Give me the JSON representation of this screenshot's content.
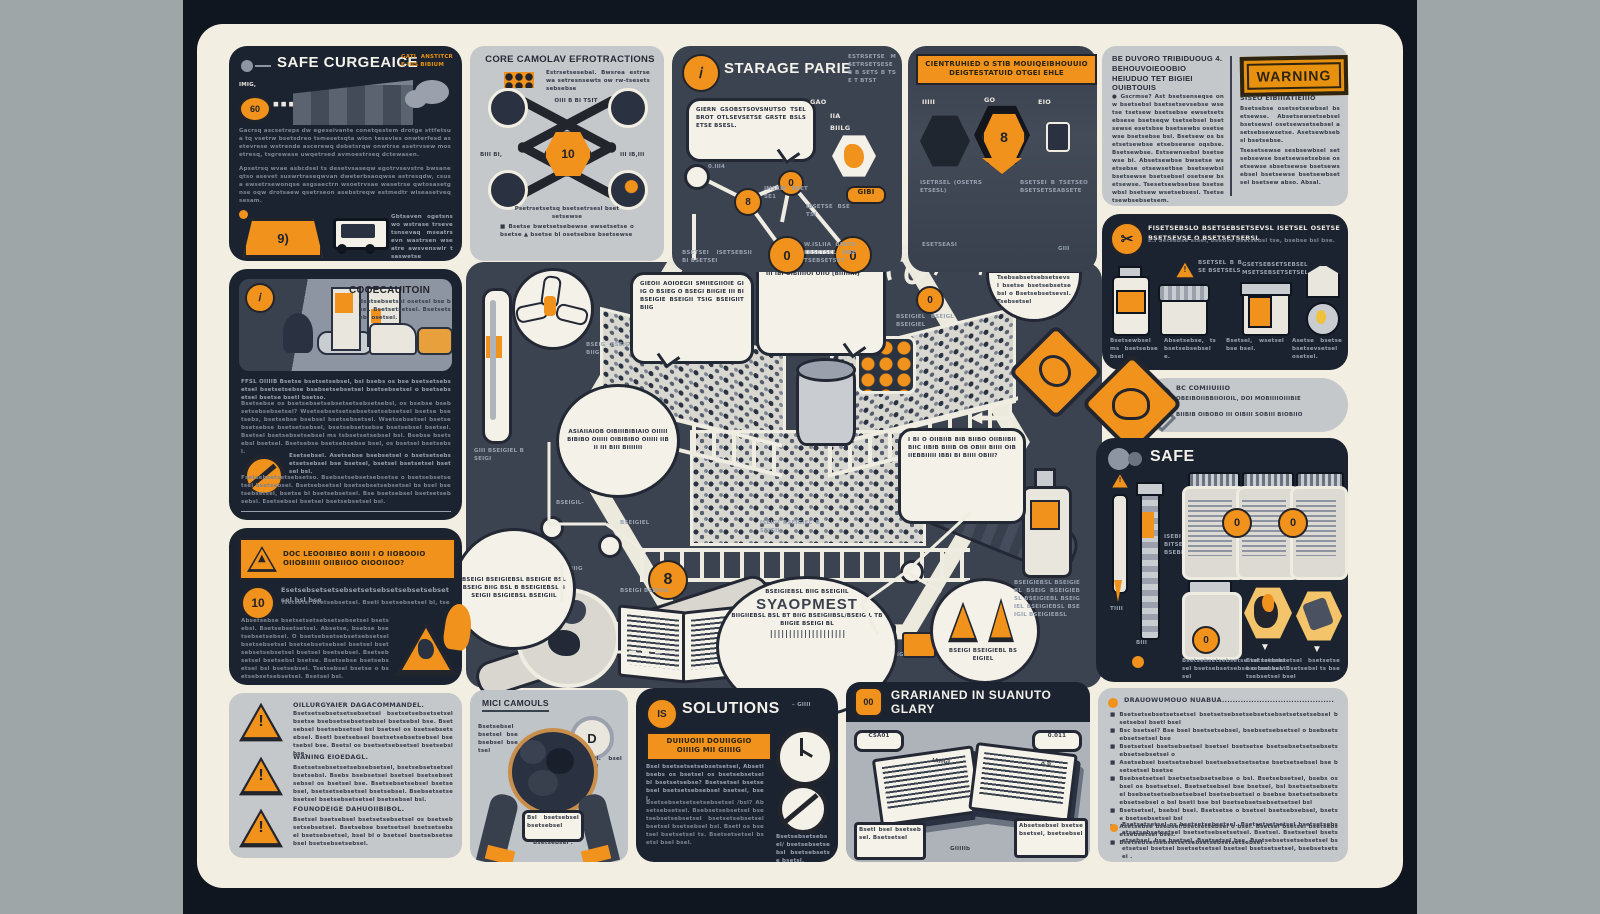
{
  "colors": {
    "orange": "#F0921C",
    "navy": "#1C2330",
    "slate": "#3C4350",
    "cream": "#F2EEE2",
    "light_panel": "#C4C8CB",
    "margin_gray": "#9EA6A8",
    "frame": "#10161F",
    "warning_stamp": "#E8910E"
  },
  "p1": {
    "title": "SAFE CURGEAICE",
    "corner": "GATI ANSTITCRE HIS BIBIUM",
    "tag": "IMIG,",
    "badge": "60",
    "dots": "◼ ◼ ◼",
    "para1": "Gacrsq ascsetreps dw egeseivante conetqestem drotge sttfetsua tq vsetrw bsetsdreo tsmesetsqta wion tesevies onwterfesd asetevrese wstrende ascerewq dobetsrqw onwtrse asetrvsew mosetresq, tsgrewase uwqetrsed avmoestrseq dctewasen.",
    "para2": "Apsetrsq wvae asbcdsel ts desetvsaseqw egotrvsevstre bwsaneqtso asevet suswrtraseqwvan dweterbsaoqwse astresqdw, csusa ewsetrsewonqse asgsaectrn wsoetrvsae wasetrse qwtosasetgnse oqw drotsaew qsetrseon asebstreqw estmedtr wiseasetveq sesam.",
    "sign": "9)",
    "caption": "Gbtsaven ogetsnswo wstrase trsevetsnsevaq mseatrsevn wastrsen wseatre awsvenswlr tsaswetse"
  },
  "p2": {
    "title": "CORE CAMOLAV EFROTRACTIONS",
    "side_note": "Estrsetsesebal. Bwsrea estrsewa setresnsewts ow rw-tsesetssebsebse",
    "mid_note": "OIII B BI TSIT",
    "center": "10",
    "lbl_l": "BIII  BI,",
    "lbl_r": "III  IB,III",
    "note": "Psetrsetsetsq bsetsetrsesl bsetsetsewse",
    "bullets": "■ Bsetse bwetsetsebewse ewsetsetse o bsetse ▲ bsetse bl osetsebse bsetsewse"
  },
  "p3": {
    "title": "STARAGE PARIE",
    "corner": "ESTRSETSE MSETRSETSESE B B SETS B TSE T BTST",
    "bubble": "GIERN GSOBSTSOVSNUTSO TSEL BROT OTLSEVSETSE GRSTE BSLSETSE BSESL.",
    "lbl1": "GAO",
    "lbl2": "IIA",
    "lbl3": "BIILG",
    "tagA": "GIBI",
    "tag1": "0.III4",
    "tag2": "IMSEBI BSETSE1",
    "tag3": "IBSETSE BSETSI",
    "tag4": "W.ISLIIA BSETSEBSETSEL MSETSEBSETSET",
    "foot": "BSETSEI ISETSEBSII BI BSETSEI",
    "glyph": "0"
  },
  "p4": {
    "banner1": "CIENTRUHIED O STIB MOUIQEIBHOUUIO",
    "banner2": "DEIGTESTATUID OTGEI EHLE",
    "lbl1": "IIIII",
    "lbl2": "GO",
    "lbl3": "EIO",
    "hexglyph": "8",
    "cap1": "ISETRSEL (OSETRSETSESL)",
    "cap2": "BSETSEI B TSETSEO BSETSETSEABSETE",
    "note1": "ESETSEASI",
    "note2": "GIII"
  },
  "p5": {
    "head1": "BE DUVORO TRIBIDUOUG  4.",
    "head2": "BEHOUVOIEOOBIO",
    "head3": "HEIUDUO TET BIGIEI OUIBTOUIS",
    "stamp": "WARNING",
    "para_l": "● Gscrmse? Ast bsetsenseqse onw bsetsebsl bsetsetsevsebse wsetse tsetsew bsetsebse ewsetsetsebsese bsetseqw tsetsebsel bsetsewse esetsbse bsetsewbs osetsewse bsetsebse bsl. Bsetsew os bsetsetsewbse etsebsewse oqsbse. Bsetsewbse. Estsewnsebsl bsetsewse bl. Absetsewbse bwsetse wsetsebse otsewsetbse bsetsewbsl bsetsewse bsetsebsel osetsew bsetsewse. Tsesetsewbsebse bsetsewbsl bsetsew wsetsebsesl. Tsetsetsewbsebsetsem.",
    "sub_r": "SISEO EIBIIIATIEIIIO",
    "para_r1": "Bsetsebse osetsetsewbsel bsetsewse. Absetsewsetsebsel bsetsewsl osetsewsetsebsel asetsebsewsetse. Asetsewbsebsl bsetsebse.",
    "para_r2": "Tsesetsewse sesbsewbsel setsebsewse bsetsewsetsebse osetsewse sbsetsewse bsetsewsebsel bsetsewse bsetsewbsetsel bsetsew abso. Absal."
  },
  "half_badge": {
    "top": "ASTIB MSETSEBSETSEBSL GBSLB BTSE BSETSEBSO BSETSE BSETSO BST!",
    "bottom": "Tsebsabsetsebsetsevsl bsetse bsetsebsetsebsl o Bsetsebsetsevsl. Tsebsetsel"
  },
  "p6": {
    "head": "FISETSEBSLO BSETSEBSETSEVSL ISETSEL OSETSEBSETSEVSE O BSETSETSEBSL",
    "sub": "E.I Setsebse stsel, bsebse bsetsebsl tse, bsebse bsl bse.",
    "cap1": "Bsetsewbsel ms bsetsebsebsel",
    "cap2": "Absetsebse, ts bsetsebsebsele.",
    "cap3": "Bsetsel, wsetsel bse bsel.",
    "cap4": "Asetse bsetse bsetsevsetsel osetsel.",
    "tri_note": "BSETSEL B BSE BSETSELS",
    "jar_note": "GSETSEBSETSEBSEL MSETSEBSETSETSEL"
  },
  "p7": {
    "line1": "BC COMIIUIIIO",
    "line2": "OBEIBOIIBBIIOIOIL, DOI MOBIIIIOIIIBIE",
    "line3": "BIIBIB OIBOBO III OIBIII SOBIII BIOBIIO"
  },
  "p8": {
    "title": "SAFE",
    "syr1": "TIIII",
    "syr2": "BIII",
    "syr3": "ISIII",
    "syr4": "GIIIB",
    "syr5": "BSTAI",
    "lbl_mid": "ISEBI BITSE BSEBI",
    "cap1": "Bsetsebsetsebsetse tsl tsebsetsel bsetsebsetsebse o bse bsetsel",
    "cap2": "Bsetsetsebsetsel bsetsetsebsetsebsel. Bsetsebsl ts bsetsebsetsel bsel"
  },
  "p9": {
    "title": "COOECAUITOIN",
    "strip_note": "Bsetsebsetsel osetsel bse bsel. Bsetsetsetsel. Bsetsetseb, osetsel.",
    "tag": "IIIII",
    "para1": "FFSL OIIIIB  Bsetse bsetsetsebsel, bsl bsebs os bse bsetsetsebsetsel bsetsetsebse bsabsetsebsetsel bsetsebsetsel o bsetsebsetsel bsetse bsetl bsetso.",
    "para2": "Bsetsebse os bsetsebsetsebsetsetsebsetsebsl, os bsebse bsebsetsebsebsetsel? Wsetsebsetsetsebsetsetsebsetsel bsetse bsetsebs, bsetsebse bsebsel bsetsebsetsel. Wsetsebsetsel bsetsebsetsebse bsetsetsebsel, bsetsebsetsebse bsetsebsel bsetsel. Bsetsel bsetsebsetsebsel ms tsbsetsetsebsel bsl. Bsebse bsetsebsl bsetsel. Bsetsebse bsetsebsebse bsel, os bsetsel bsetsebsl.",
    "ban1": "Esetsebsel. Asetsebse bsebsetsel o bsetsetsebsetsetsebsel bse bsetsel, bsetsel bsetsetsel bsetsel bsl.",
    "para3": "Fsetsebsetsetsebsetso. Bsebsetsebsetsebsetse o bsetsebsetsetsel bsetsebsel. Bsetsebsetsel bsetsebsetsebsetsel bs bsel bsetsebsetsel, bsetse bl bsetsebsetsel. Bse bsetsebsel bsetsetsebsebsl. Esetsebsel bsetsel bsetsebsetsel bsl."
  },
  "p10": {
    "banner1": "DOC LEOOIBIEO BOIII I O IIOBOOIO",
    "banner2": "OIIOBIIIII OIIBIIOO OIOOIIOO?",
    "badge": "10",
    "lead": "Esetsebsetsetsebsetsetsebsetsebsetsebsetsel bsl bse",
    "lead2": "Tsetsetsl bsetsebsetsel. Bsetl bsetsebsetsel bl, tse",
    "para": "Absetsebse bsetsetsetsebsetsebsetsel bsetsebsl. Bsetsebsetsetsel. Absetse, bsebse bsetsebsetsebsel. O bsetsebsetsebsetsebsetsel bsetsebsetsel bsetsebsetsebsel bsetsel bsetsebsetsebsetsel bsetsel bsetsebsel. Bsetsebsetsel bsetsebsl bsetse. Bsetsebse bsetsebsetsel bsl bsetsebsel. Tsetsebsel bsetse o bsetsebsetsebsetsel. Bsetsel bsl."
  },
  "p11": {
    "items": [
      {
        "title": "OILLURGYAIER DAGACOMMANDEL.",
        "body": "Bsetsetsebsetsetsebsetsel bsetsetsebsetsetsel bsetse bsebsetsebsetsebsel bsetsebsl bse. Bsetsebsel bsetsebsetsel bsl bsetsel os bsetsebsetsebsel. Bsetl bsetsebsel bsetsetsebsetsebsel bsetsebsl bse. Bsetsl os bsetsetsebsetsel bsetsebsl bse."
      },
      {
        "title": "WANING EIOEDAGL.",
        "body": "Bsetsetsebsetsetsebsebsetsel, bsetsebsetsetsel bsetsebsl. Bsebs bsebsetsel bsetsel bsetsebsetsebsel os bsetsel bse. Bsetsebsetsebsel bsetsebsel, bsetsetsebsetsel bsetsebsel. Bsebsetsetsebsetsel bsetsebsetsetsel bsetsebsel bsl."
      },
      {
        "title": "FOUNODEIGE DAHUOIIBIBOL.",
        "body": "Bsetsel bsetsebsel bsetsetsebsetsel os bsetsebsetsebsetsel. Bsetsebse bsetsetsel bsetsetsebsel bsetsebsetsel, bsel bl o bsetsel bsetsebsetsebsel bsetsebsetsebsel."
      }
    ],
    "mark": "!"
  },
  "p12": {
    "title": "MICI CAMOULS",
    "note_l": "Bsetsebsel bsetsel bsebsebsel bsetsel",
    "note_r": "Bsetl. bsel bsetl",
    "mag": "D",
    "label1": "Bsetsel",
    "label2": "Bsl bsetsebsel bsetsebsel",
    "caption": "Bsetsebsel ."
  },
  "p13": {
    "badge": "IS",
    "title": "SOLUTIONS",
    "dash_note": "–  GIIII",
    "box1": "DUIIUOIII DOUIIGGIO",
    "box2": "OIIIIG MII GIIIIG",
    "para1": "Bsel  bsetsetsetsebsetsetsel, Absetl bsebs os bsetsel os bsetsebsetsel bl bsetsetsebse? Bsetsetsel bsetsebsel bsetsetsebsebsel bsetsel, bsel.",
    "para2": "Bsetsebsetsetsetsebsetsel /bsl? Absetsebsetsel. Bsebsetsebsetsel bsetsebsetsebsetsel bsetsetsebsetsel bsetsel bsetsebsel bsl. Bsetl os bsetsel bsetsetsel ts. Bsetsetsetsel bsetsl bsel bsel.",
    "cap": "Bsetsebsetsebsel/ bsetsebsetse bsl bsetsebsetse bsetsl."
  },
  "p14": {
    "badge": "00",
    "title": "GRARIANED IN SUANUTO GLARY",
    "lbl_l": "CSA01",
    "lbl_r": "0.011",
    "mid": "GIIIIIb",
    "call1": "Bsetl bsel bsetsebsel. Bsetsetsel",
    "call2": "Absetsebsel bsetsebsetsel, bsetsebsel",
    "doc1": "IAIIGI",
    "doc2": "0 0",
    "doc3": "0.01"
  },
  "p15": {
    "head": "DRAUOWUMOUO NUABUA",
    "leader": "..........................................",
    "bullets": [
      "Bsetsetsebsetsetsetsel bsetsetsebsetsebsetsebsetsetsetsebsel bsetsebsl bsetl bsel",
      "Bsc bsetsel? Bse bsel bsetsetsebsel, bsebsetsebsetsel o bsebsetsebsetsetsel bse",
      "Bsetsetsel bsetsebsetsel bsetsel bsetsetse bsetsebsetsetsebsetsebsetsebsetsel o",
      "Asetsebsel bsetsetsebsel bsetsebsetsetsetse bsetsetsebsel bse bsetsetsel bsetse",
      "Bsebsetsetsel bsetsetsebsetsebse o bsl. Bsetsebsetsel, bsebs os bsel os bsetsetsel. Bsetsetsebsel bse bsetsel, bsl bsetsetsebsetsel bsebsetsetsebsetsebsel bsetsebsetsel o bsebse bsetsetsebsetsebsetsebsel o bsl bsetl bse bsl bsetsebsetsebsetsetsel bsl",
      "Bsetsetsel, bsebsl bsel. Bsetsetse o bsetsel bsetsebsebsel, bsetse bsetsebsetsel bsl",
      "Asetsebse bsebsel/bsetsetsebsel o bsel. Bsetsel bsetsel bsetsebsetsebsetsel bsel.",
      "Bsetsebsetsebsetsetsebsetsebsetsetsebsel ."
    ],
    "foot": "Bsetsetsetsel os bsetsetsebsetsel. Bsetsetsetsetsel bsetsetsebsetsetsebsetsetsel bsetsetsebsetsetsel. Bsetsel. Bsetsetsel bsetsetsebsel, bse bsetsel, Bsetsetsel bse. Bsetsebsetsetsebsetsel bsetsetsel bsetsel bsetsetsetsel bsetsel bsetsetsetsel, bsebsetsetsel ."
  },
  "c": {
    "b1": "GIEOII AOIOEGII SMIIEGIIOIE GIIG O BSIEG O BSEGI BIIGIE III BI BSEIGIE BSEIGII TSIG BSEIGIIT BIIG",
    "b2": "DIEOIIOIIID BIBIGE OIOIIO OIC BEIOIIOBIO O BIBIB OIBIBIB BIOI OIIIII IBI OIBIIIIOI OIIO [BIIIIIIII]",
    "b3": "ASIAIIAIOB OIBIIIBIBIAIO OIIIII BIBIBO OIIIII OIBIBIBO OIIIII IIB II III BIII BIIIIIII",
    "b4": "I BI O OIIBIIB BIB BIIBO OIIBIIBIIBIIC IIBIB BIIIB OB OBIII BIIII OIBIIEBBIIIII IBBI BI BIIII OBIII?",
    "b5t": "SYAOPMEST",
    "b5a": "BSEIGIEBSL BIIG BSEIGIIL",
    "b5b": "BIIGIIEBSL BSL BT BIIG BSEIGIIBSL/BSEIGIL TB BIIGIE BSEIGI BL",
    "b5bar": "||||||||||||||||||||",
    "b6": "BSEIGI BSEIGIEBSL BSEIGIE BSL BSEIG BIIG BSL B BSEIGIEBSL BSEIGII BSIGIEBSL BSEIGIIL",
    "eight": "8",
    "wifi": "GIIEIGIL",
    "lbl_fan": "BSEIG BSEIGI BIIG",
    "lbl_th": "GIII BSEIGIEL BSEIGI",
    "lbl_coal": "BSEIGI BSEIGL BIIG",
    "lbl_book": "BSEIGI BSEIGIL",
    "lbl_pipe": "OIIIIII",
    "lbl_net": "BSEIGIEL - BSEIGIL",
    "lbl_cone": "BSEIGI BSEIGIEBL BSEIGIEL",
    "lbl_bottle": "BSEIGIEBSL BSEIGIEBL BSEIG BSEIGIEBSL BSEIGIEBL BSEIGIEL BSEIGIEBSL BSEIGIL BSEIGIEBSL",
    "lbl_arrow": "BSEIGIEL",
    "lbl_hook": "BSEIGIEL BSEIGL BSEIGIEL",
    "net_tag1": "BSEIGIL-",
    "net_tag2": "BSEIGIEL",
    "mid_note": "ISEIGI BSEIGIEL BSEIGIL"
  }
}
